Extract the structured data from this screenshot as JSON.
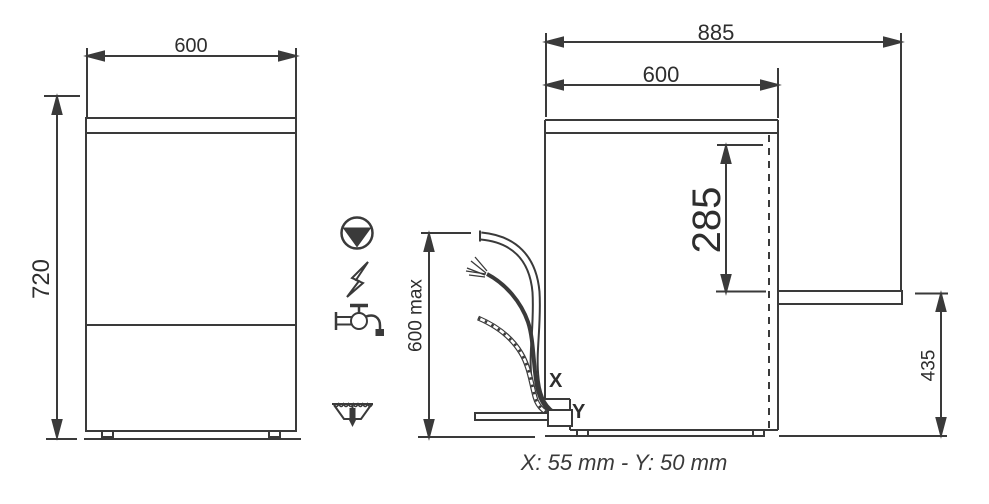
{
  "colors": {
    "line": "#3a3a3a",
    "text": "#2e2e2e",
    "background": "#ffffff"
  },
  "front_view": {
    "width": "600",
    "height": "720"
  },
  "side_view": {
    "overall_depth": "885",
    "cabinet_depth": "600",
    "drain_span": "285",
    "drain_outlet_height": "435",
    "hose_reach": "600 max",
    "x_point": "X",
    "y_point": "Y"
  },
  "icons": [
    {
      "name": "drain-pump-icon"
    },
    {
      "name": "electric-supply-icon"
    },
    {
      "name": "water-tap-icon"
    },
    {
      "name": "floor-drain-icon"
    }
  ],
  "caption": "X: 55 mm - Y: 50 mm"
}
